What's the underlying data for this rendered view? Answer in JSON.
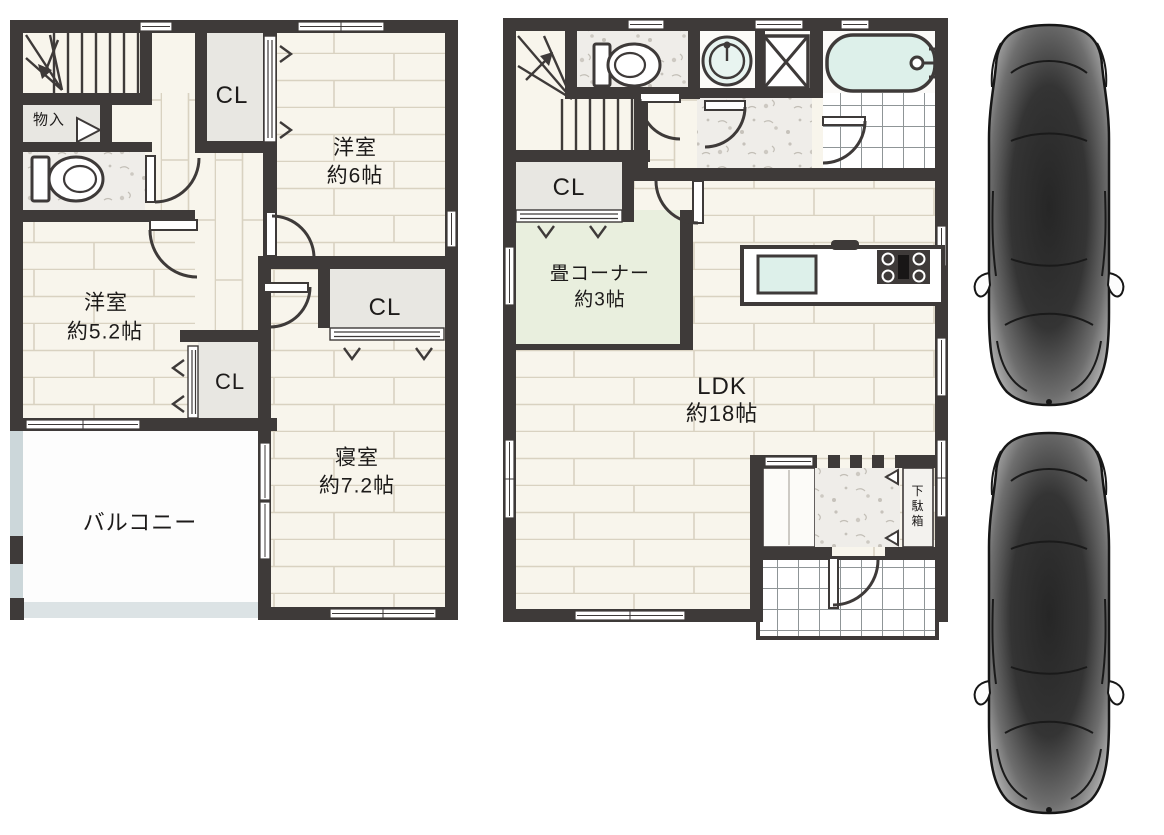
{
  "document": {
    "type": "floor-plan",
    "floors": 2,
    "cars_shown": 2
  },
  "plans": {
    "floor2": {
      "storage": "物入",
      "closet_top": "CL",
      "western6_name": "洋室",
      "western6_size": "約6帖",
      "western52_name": "洋室",
      "western52_size": "約5.2帖",
      "closet_mid": "CL",
      "closet_small": "CL",
      "bedroom_name": "寝室",
      "bedroom_size": "約7.2帖",
      "balcony": "バルコニー"
    },
    "floor1": {
      "closet": "CL",
      "tatami_name": "畳コーナー",
      "tatami_size": "約3帖",
      "ldk_name": "LDK",
      "ldk_size": "約18帖",
      "shoe_cabinet": "下駄箱"
    }
  },
  "colors": {
    "wall": "#3e3a39",
    "floor_wood": "#f8f5ec",
    "plank_line": "#d9d2c1",
    "closet_fill": "#e8e7e2",
    "tatami_green": "#e9efde",
    "bath_cyan": "#ddf0ea",
    "balcony_rail": "#ccd7da",
    "speckle_floor": "#efede9",
    "car_body_dark": "#262626",
    "text": "#1d1b1a"
  }
}
